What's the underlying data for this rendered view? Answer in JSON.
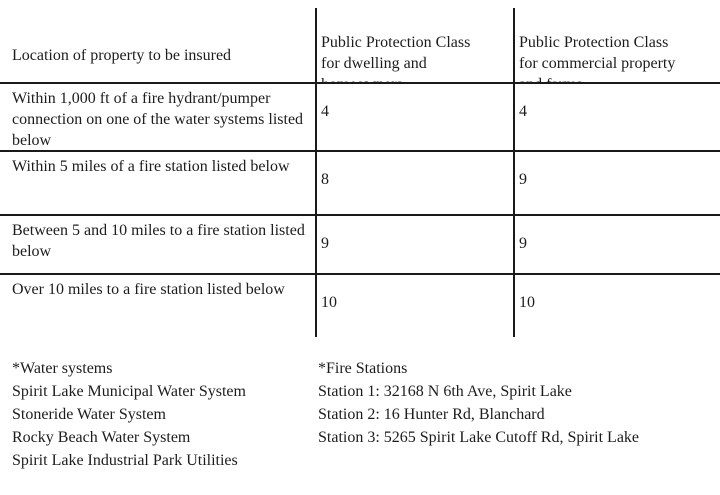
{
  "table": {
    "header": {
      "location": "Location of property to be insured",
      "dwelling": "Public Protection Class\nfor dwelling and\nhomeowners",
      "commercial": "Public Protection Class\nfor commercial property\nand farms"
    },
    "rows": [
      {
        "location": "Within 1,000 ft of a fire hydrant/pumper connection on one of the water systems listed below",
        "dwelling": "4",
        "commercial": "4"
      },
      {
        "location": "Within 5 miles of a fire station listed below",
        "dwelling": "8",
        "commercial": "9"
      },
      {
        "location": "Between 5 and 10 miles to a fire station listed below",
        "dwelling": "9",
        "commercial": "9"
      },
      {
        "location": "Over 10 miles to a fire station listed below",
        "dwelling": "10",
        "commercial": "10"
      }
    ]
  },
  "footnotes": {
    "water_systems": {
      "title": "*Water systems",
      "items": [
        "Spirit Lake Municipal Water System",
        "Stoneride Water System",
        "Rocky Beach Water System",
        "Spirit Lake Industrial Park Utilities"
      ]
    },
    "fire_stations": {
      "title": "*Fire Stations",
      "items": [
        "Station 1: 32168 N 6th Ave, Spirit Lake",
        "Station 2: 16 Hunter Rd, Blanchard",
        "Station 3: 5265 Spirit Lake Cutoff Rd, Spirit Lake"
      ]
    }
  },
  "colors": {
    "background": "#ffffff",
    "text": "#1c1c1c",
    "line": "#1a1a1a"
  }
}
